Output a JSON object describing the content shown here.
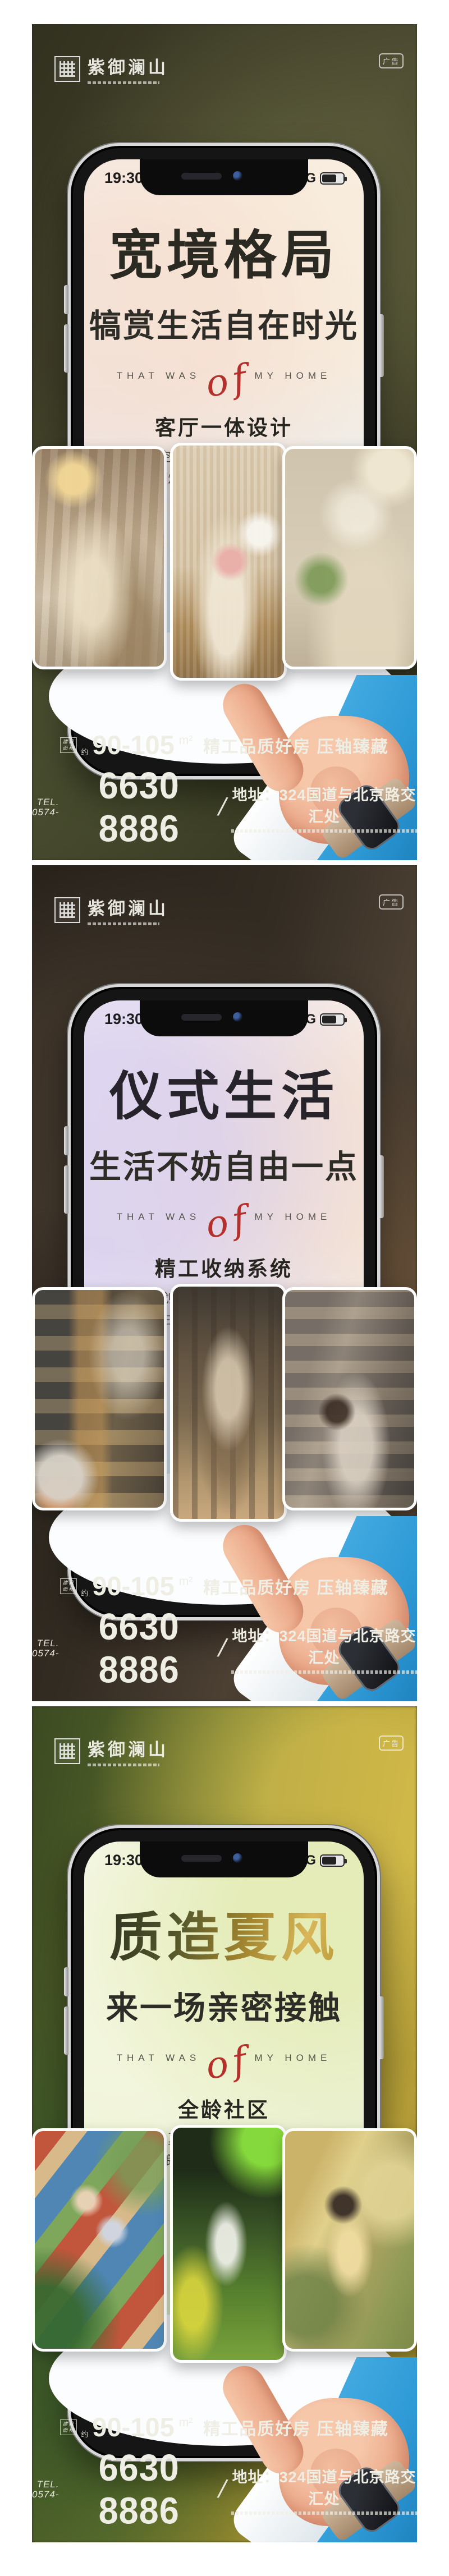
{
  "brand": {
    "name": "紫御澜山",
    "ad_badge": "广告"
  },
  "status_bar": {
    "time": "19:30",
    "network": "5G"
  },
  "tagline": {
    "left": "THAT WAS",
    "script": "of",
    "right": "MY HOME"
  },
  "footer": {
    "area_label_line1": "建筑",
    "area_label_line2": "面积",
    "approx": "约",
    "area_value": "90-105",
    "area_unit": "m²",
    "slogan": "精工品质好房 压轴臻藏",
    "tel_label": "TEL.",
    "tel_prefix": "0574-",
    "tel_number": "6630 8886",
    "divider": "/",
    "address": "地址：324国道与北京路交汇处"
  },
  "colors": {
    "accent_red": "#b5302a",
    "sleeve_blue": "#2e9ad6",
    "gold": "#c9a43c"
  },
  "panels": [
    {
      "title": "宽境格局",
      "subtitle": "犒赏生活自在时光",
      "section_title": "客厅一体设计",
      "desc_line1": "极致空间利用 让风光互通有序",
      "desc_line2": "家人闲坐 灯火可亲 宴客会友从容有度",
      "photo_left": "warm-living-room-dried-flowers",
      "photo_center": "woman-reading-on-sofa-with-cat",
      "photo_right": "sunlit-wall-sofa-with-plant"
    },
    {
      "title": "仪式生活",
      "subtitle": "生活不妨自由一点",
      "section_title": "精工收纳系统",
      "desc_line1": "划分衣物的专属区域",
      "desc_line2": "私享生活仪式感 日常从容优雅",
      "photo_left": "lit-glass-wardrobe-orange-bag",
      "photo_center": "walk-in-closet-hanging-clothes",
      "photo_right": "vanity-dresser-mirror"
    },
    {
      "title": "质造夏风",
      "subtitle": "来一场亲密接触",
      "section_title": "全龄社区",
      "desc_line1": "夏天的风穿堂而过",
      "desc_line2": "疏朗清风 沉醉浪漫岁月",
      "photo_left": "kids-running-colorful-playground",
      "photo_center": "couple-on-garden-chairs",
      "photo_right": "woman-in-yellow-among-leaves"
    }
  ]
}
